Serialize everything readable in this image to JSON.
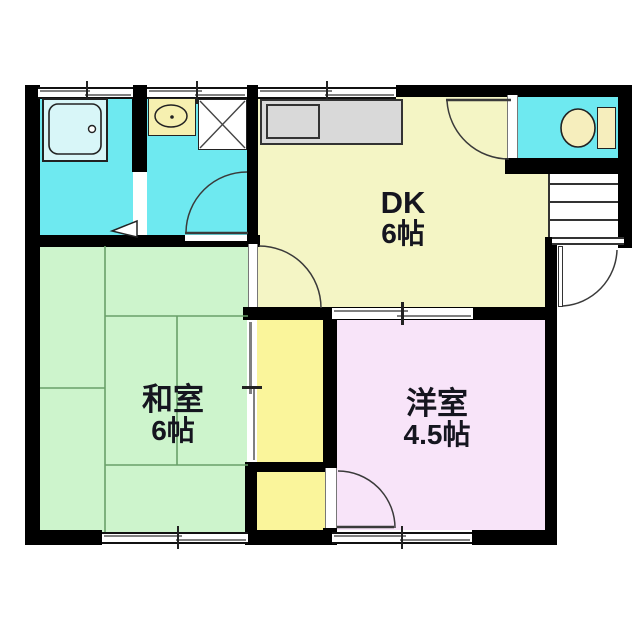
{
  "plan_title": "1DK+1 floor plan",
  "rooms": {
    "dk": {
      "name": "DK",
      "size": "6帖",
      "color": "#f4f5c5"
    },
    "washitsu": {
      "name": "和室",
      "size": "6帖",
      "color": "#cdf4cc"
    },
    "youshitsu": {
      "name": "洋室",
      "size": "4.5帖",
      "color": "#f8e4f9"
    },
    "bathroom": {
      "color": "#6ee9f0"
    },
    "washroom": {
      "color": "#6ee9f0"
    },
    "toilet_room": {
      "color": "#6ee9f0"
    },
    "closet_upper": {
      "color": "#faf59b"
    },
    "closet_lower": {
      "color": "#faf59b"
    }
  },
  "fixtures": {
    "bathtub": "bathtub",
    "washbasin": "washbasin",
    "washing_machine": "washing-machine-pan",
    "kitchen_counter": "kitchen-counter-with-sink",
    "toilet": "toilet",
    "stairs": "staircase",
    "entrance_door": "entrance-door",
    "tub_color": "#d8f6f8",
    "cream_color": "#f6eebd",
    "counter_color": "#d9d9d9"
  },
  "symbols": {
    "wall_color": "#000000",
    "tatami_line_color": "#69a069",
    "door_arc_color": "#3a3a3a",
    "window": "sliding-window",
    "doors": [
      "hinged-door",
      "sliding-door"
    ]
  }
}
